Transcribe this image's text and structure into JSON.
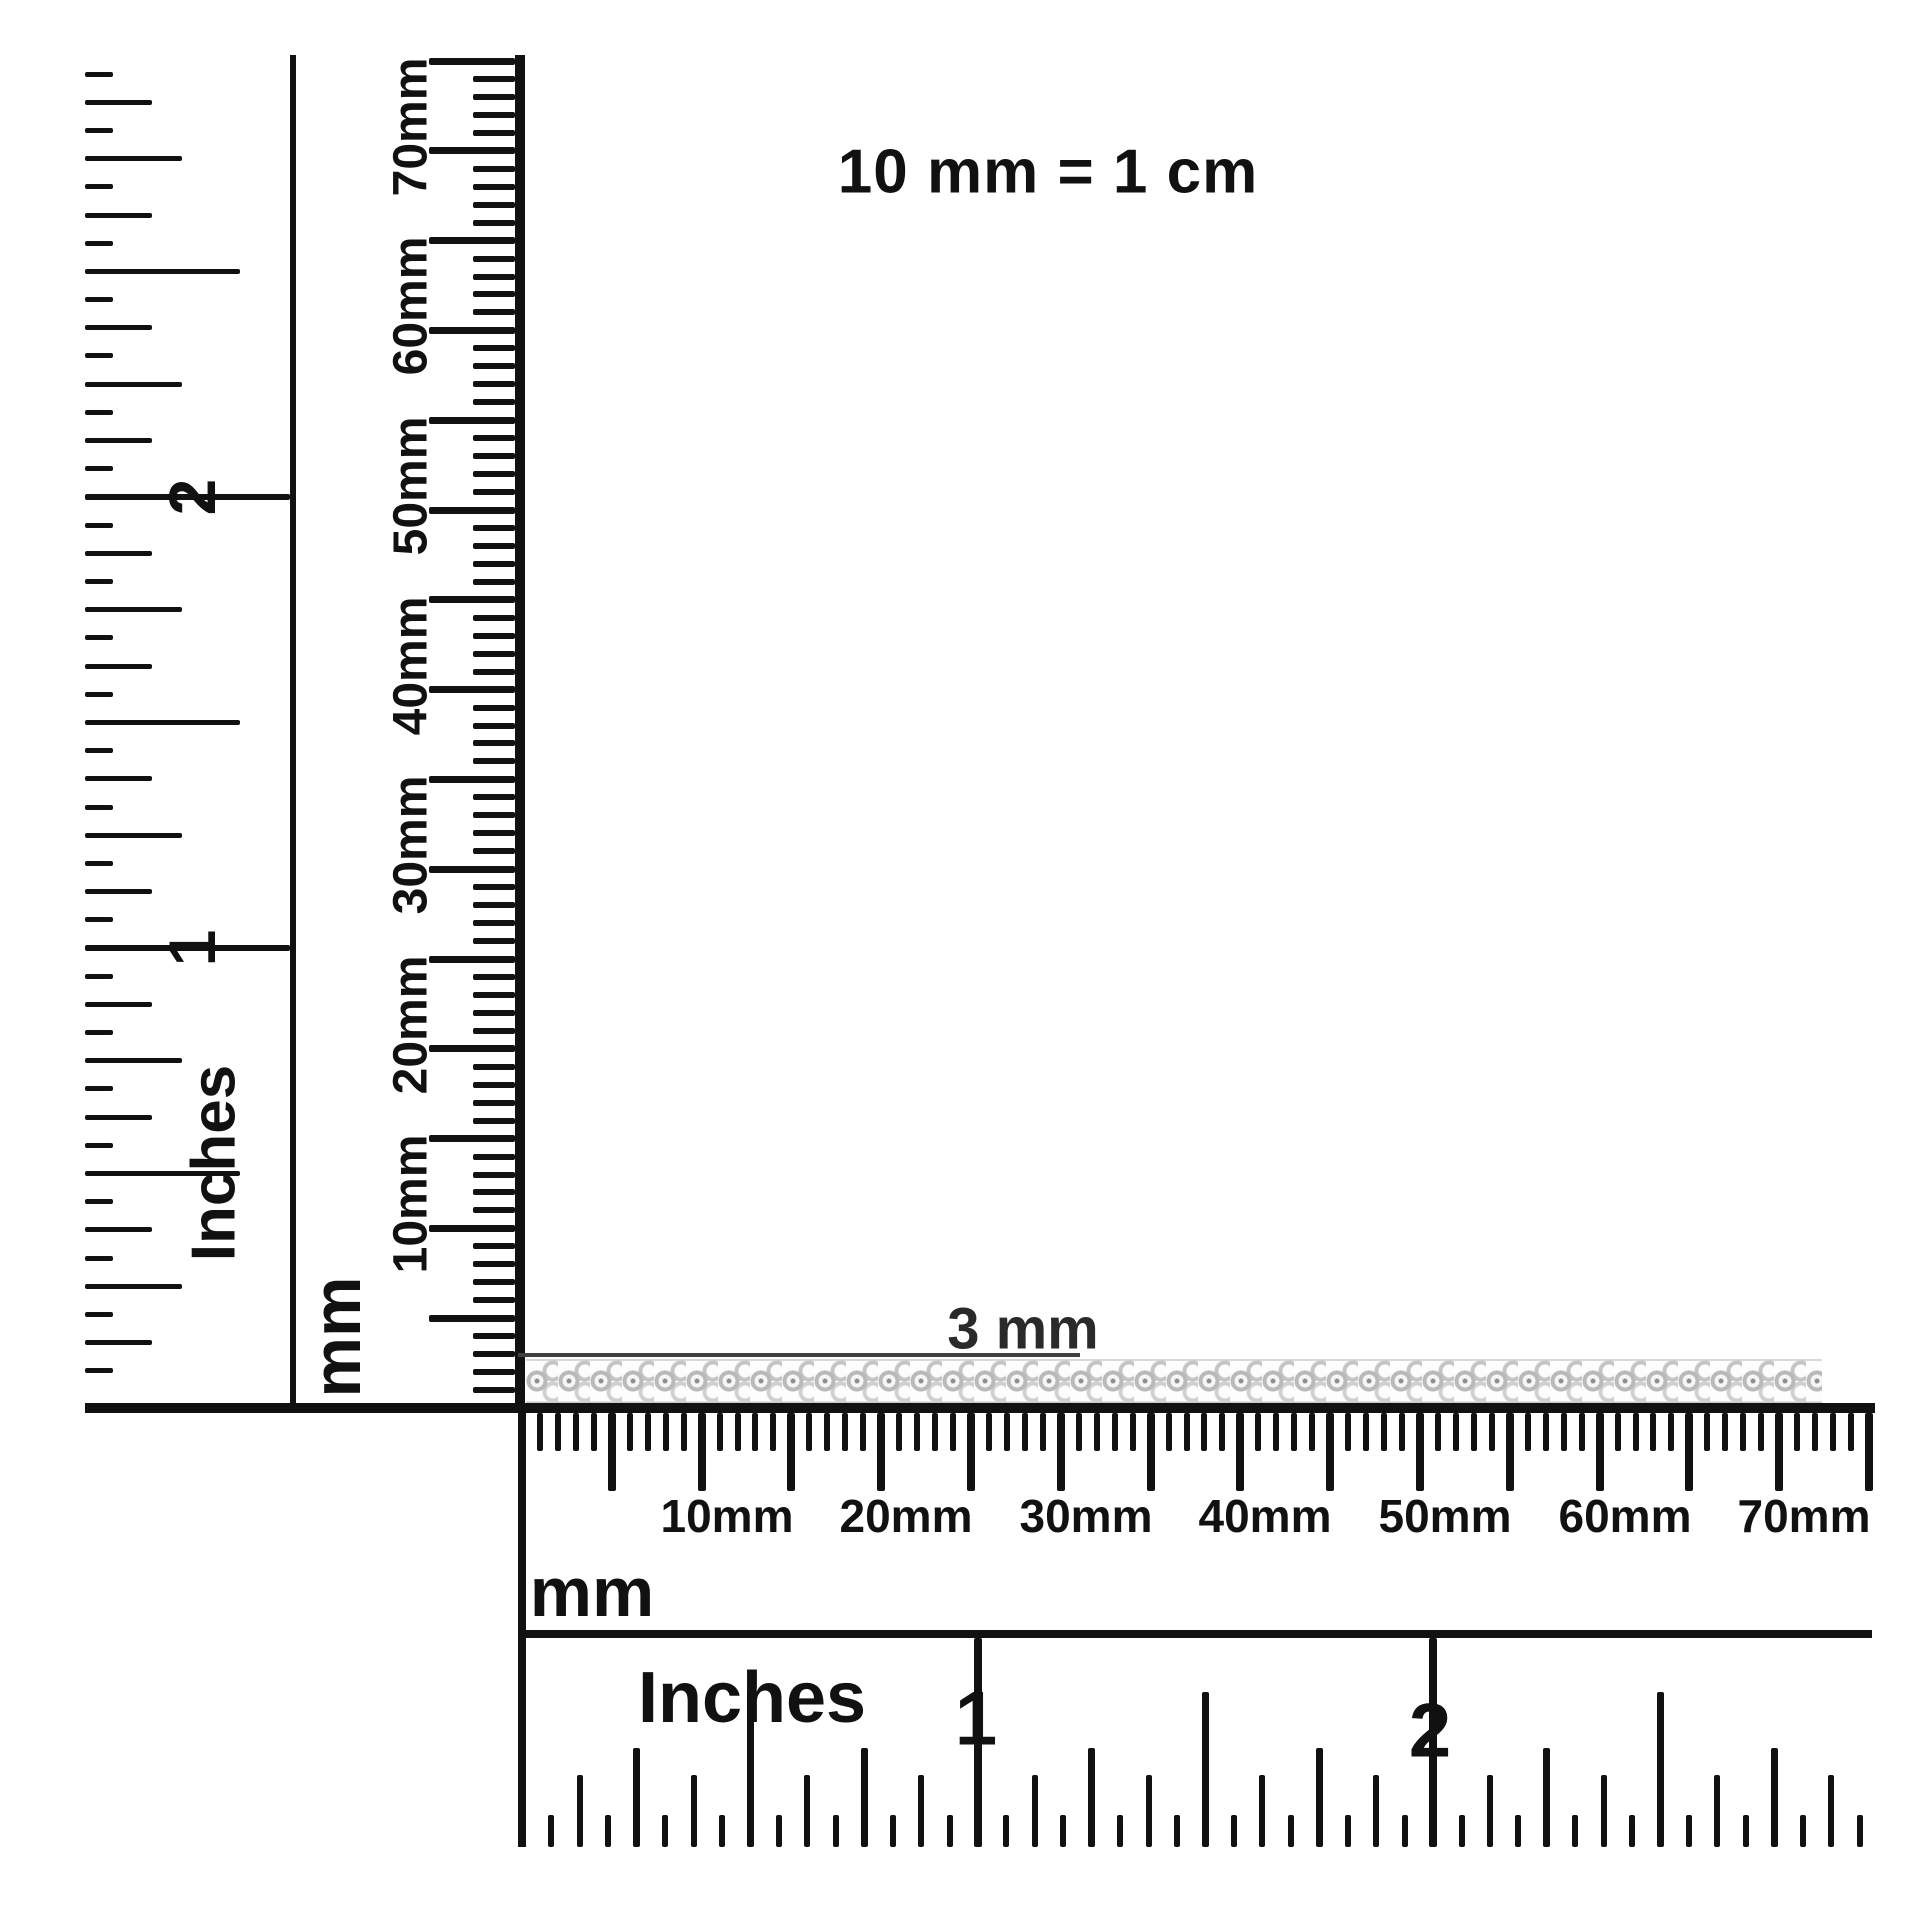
{
  "note": {
    "equivalence": "10 mm = 1 cm"
  },
  "measurement": {
    "width_label": "3 mm"
  },
  "left_inch_ruler": {
    "unit_label": "Inches",
    "numbers": [
      "1",
      "2"
    ]
  },
  "left_mm_ruler": {
    "unit_label": "mm",
    "tick_labels": [
      "10mm",
      "20mm",
      "30mm",
      "40mm",
      "50mm",
      "60mm",
      "70mm"
    ]
  },
  "bottom_mm_ruler": {
    "unit_label": "mm",
    "tick_labels": [
      "10mm",
      "20mm",
      "30mm",
      "40mm",
      "50mm",
      "60mm",
      "70mm"
    ]
  },
  "bottom_inch_ruler": {
    "unit_label": "Inches",
    "numbers": [
      "1",
      "2"
    ]
  },
  "colors": {
    "ink": "#111111",
    "leader_line": "#3f3f3f",
    "chain_silver": "#b9b9b9",
    "chain_highlight": "#f6f6f6",
    "background": "#ffffff"
  }
}
